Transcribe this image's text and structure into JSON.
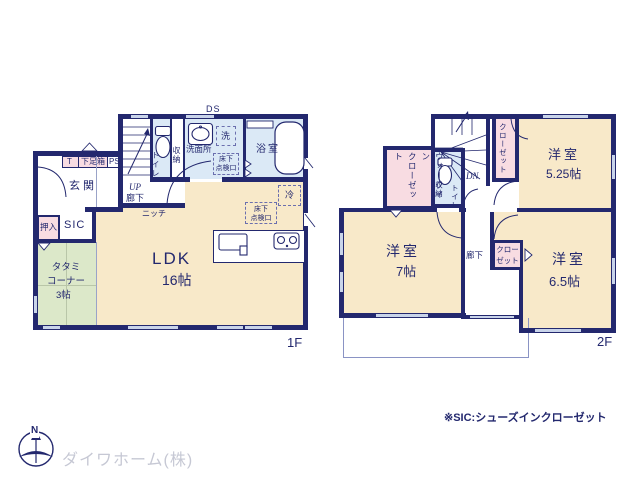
{
  "colors": {
    "wall": "#23286e",
    "room_cream": "#f8e9c9",
    "room_blue": "#dbe9f6",
    "room_pink": "#f8dce2",
    "room_green": "#dce8c9",
    "window_line": "#c9d4ea",
    "logo_gray": "#c6c8d4"
  },
  "floor1": {
    "floor_label": "1F",
    "ds": "DS",
    "up": "UP",
    "hallway": "廊下",
    "niche": "ニッチ",
    "genkan": "玄関",
    "sic": "SIC",
    "oshiire": "押入",
    "t_box": "T",
    "shoe_box": "下足箱",
    "ps": "PS",
    "toilet": "トイレ",
    "storage": "収納",
    "washroom": "洗面所",
    "laundry": "洗",
    "bath": "浴室",
    "fridge": "冷",
    "underfloor_access": "床下\n点検口",
    "ldk_name": "LDK",
    "ldk_size": "16帖",
    "tatami_name": "タタミ\nコーナー",
    "tatami_size": "3帖"
  },
  "floor2": {
    "floor_label": "2F",
    "dn": "DN",
    "hallway": "廊下",
    "toilet": "トイレ",
    "storage": "収納",
    "closet": "クローゼット",
    "closet_small": "クロー\nゼット",
    "wic": "ウォークイン\nクローゼット",
    "bedroom1_name": "洋室",
    "bedroom1_size": "5.25帖",
    "bedroom2_name": "洋室",
    "bedroom2_size": "7帖",
    "bedroom3_name": "洋室",
    "bedroom3_size": "6.5帖"
  },
  "footer": {
    "compass_north": "N",
    "company": "ダイワホーム(株)",
    "note": "※SIC:シューズインクローゼット"
  }
}
